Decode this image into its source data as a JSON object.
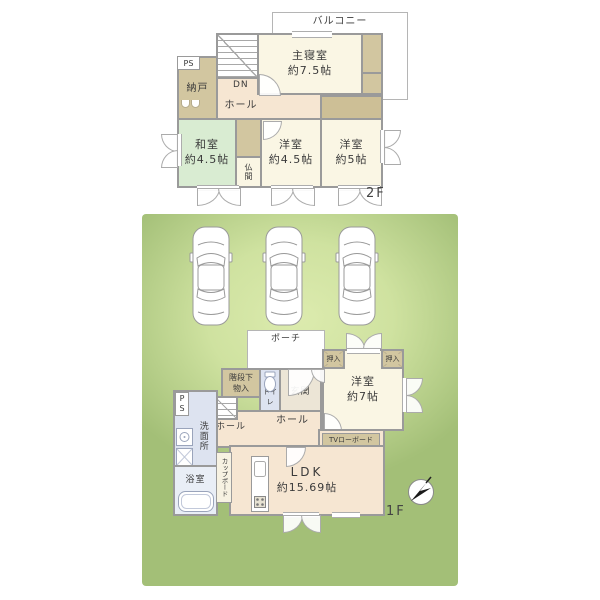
{
  "colors": {
    "wall": "#9a9a9a",
    "room_floor": "#faf6e4",
    "hall_floor": "#f6e6d2",
    "tatami_green": "#d9ecd2",
    "closet_tan": "#d2c6a0",
    "wet_area_blue": "#dde3f0",
    "yard_green": "#c8dd97",
    "white": "#ffffff"
  },
  "floor2": {
    "floor_label": "2F",
    "balcony": "バルコニー",
    "ps": "PS",
    "nando": "納戸",
    "dn": "DN",
    "hall": "ホール",
    "master_name": "主寝室",
    "master_size": "約7.5帖",
    "washitsu_name": "和室",
    "washitsu_size": "約4.5帖",
    "butsuma": "仏間",
    "western45_name": "洋室",
    "western45_size": "約4.5帖",
    "western5_name": "洋室",
    "western5_size": "約5帖"
  },
  "floor1": {
    "floor_label": "1F",
    "porch": "ポーチ",
    "closet_left": "押入",
    "closet_right": "押入",
    "western7_name": "洋室",
    "western7_size": "約7帖",
    "under_stairs_1": "階段下",
    "under_stairs_2": "物入",
    "toilet": "トイレ",
    "entrance": "玄関",
    "ps": "PS",
    "washroom": "洗面所",
    "up": "UP",
    "up_hall": "ホール",
    "hall": "ホール",
    "bathroom": "浴室",
    "cupboard": "カップボード",
    "tv_board": "TVローボード",
    "ldk_name": "LDK",
    "ldk_size": "約15.69帖",
    "car_count": 3
  },
  "icons": {
    "compass": "north-arrow",
    "car": "car-top-view",
    "toilet": "toilet-bowl",
    "bathtub": "bathtub",
    "kitchen_sink": "sink",
    "stove": "stove"
  }
}
